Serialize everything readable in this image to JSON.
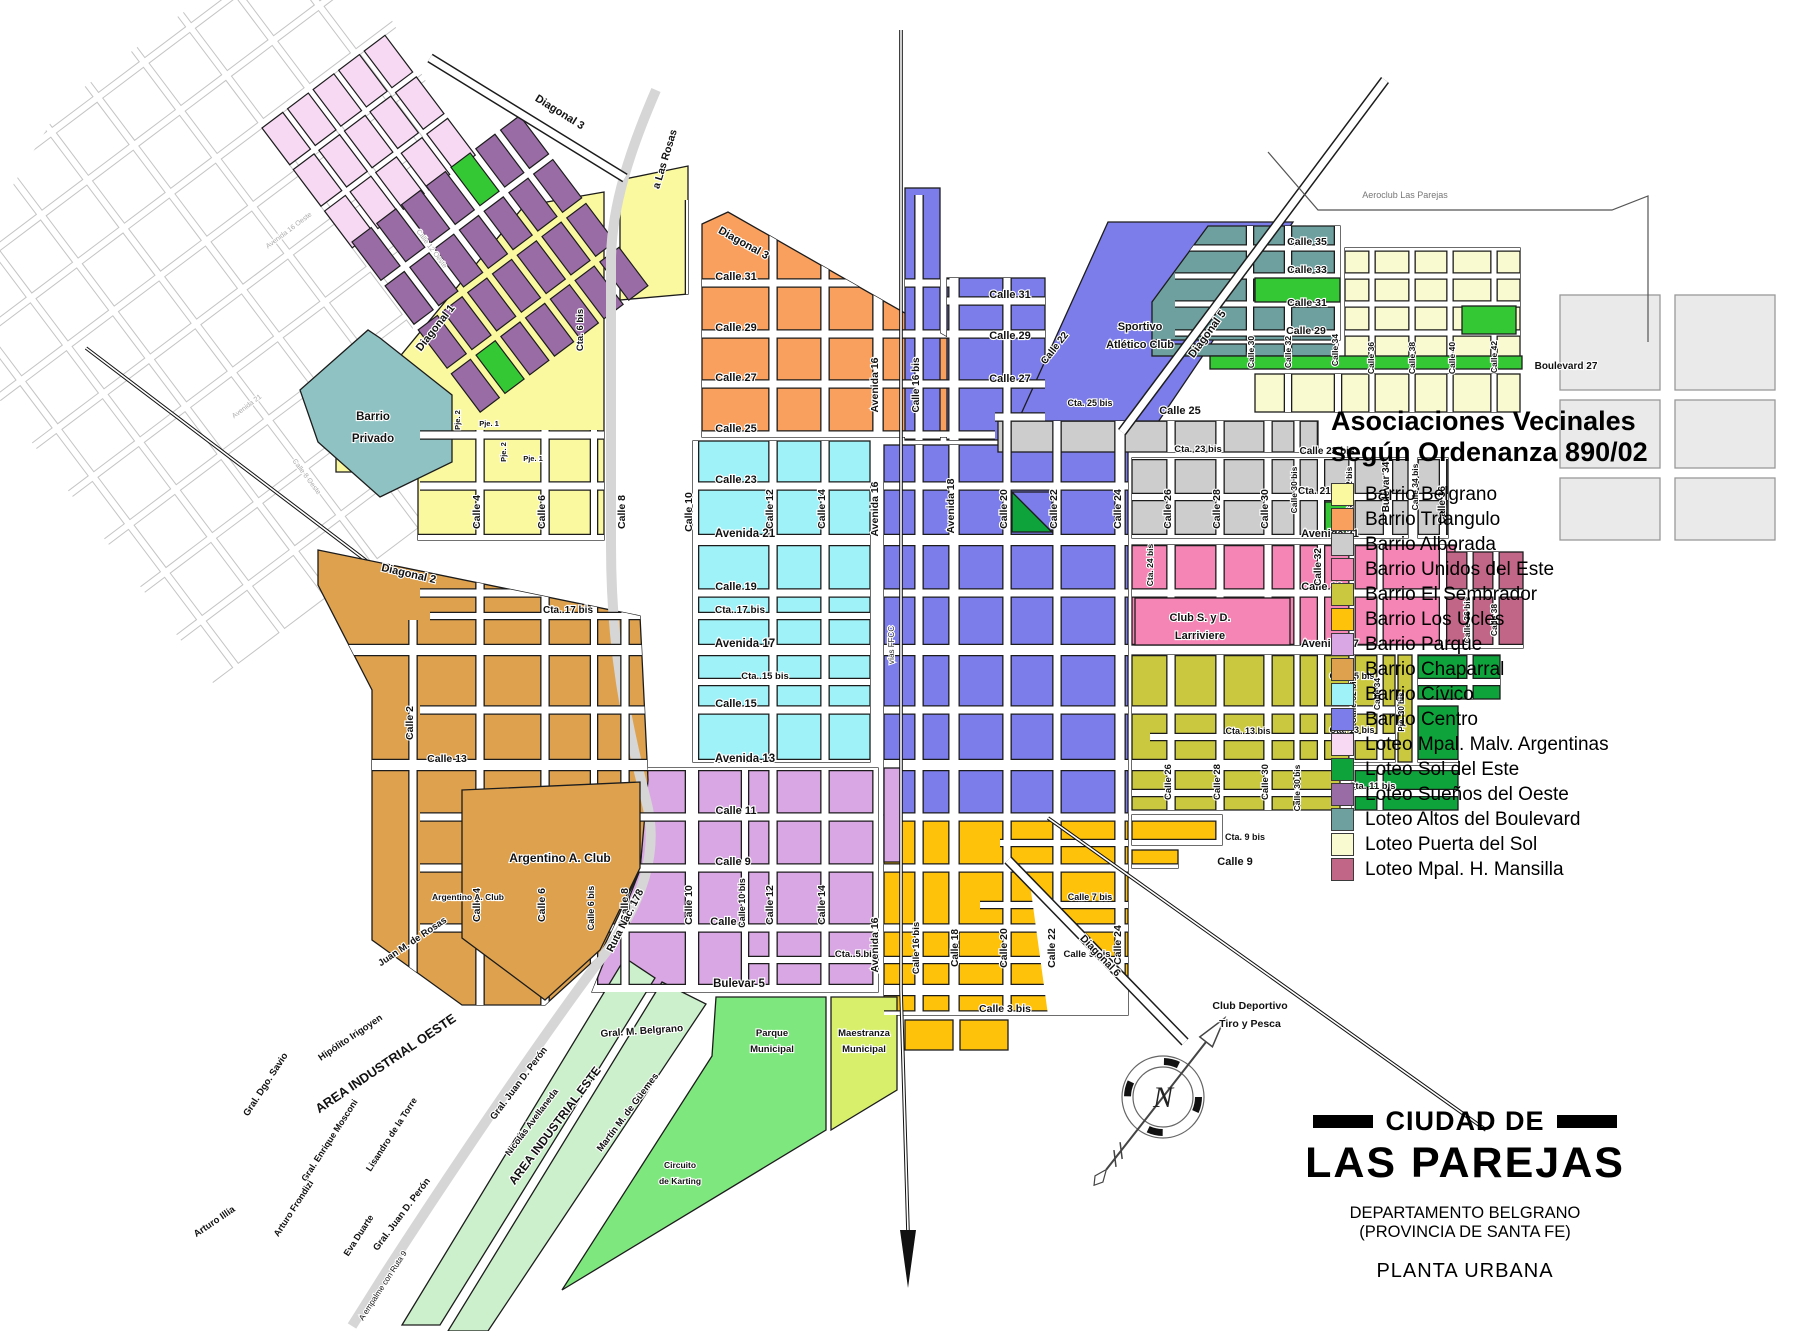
{
  "legend": {
    "title_line1": "Asociaciones Vecinales",
    "title_line2": "según Ordenanza 890/02",
    "items": [
      {
        "label": "Barrio Belgrano",
        "color": "#FAF9A0"
      },
      {
        "label": "Barrio Tríangulo",
        "color": "#F9A05F"
      },
      {
        "label": "Barrio Alborada",
        "color": "#CDCDCD"
      },
      {
        "label": "Barrio Unidos del Este",
        "color": "#F585B4"
      },
      {
        "label": "Barrio El Sembrador",
        "color": "#C9C83F"
      },
      {
        "label": "Barrio Los Ucles",
        "color": "#FFC20A"
      },
      {
        "label": "Barrio Parque",
        "color": "#D9A7E3"
      },
      {
        "label": "Barrio Chaparral",
        "color": "#DEA24F"
      },
      {
        "label": "Barrio Cívico",
        "color": "#9FF2F7"
      },
      {
        "label": "Barrio Centro",
        "color": "#7C7CEA"
      },
      {
        "label": "Loteo Mpal. Malv. Argentinas",
        "color": "#F7D9F3"
      },
      {
        "label": "Loteo Sol del Este",
        "color": "#0FA33C"
      },
      {
        "label": "Loteo Sueños del Oeste",
        "color": "#9A6CA5"
      },
      {
        "label": "Loteo Altos del Boulevard",
        "color": "#6FA0A0"
      },
      {
        "label": "Loteo Puerta del Sol",
        "color": "#FAFAD0"
      },
      {
        "label": "Loteo Mpal. H. Mansilla",
        "color": "#C26688"
      }
    ]
  },
  "title_block": {
    "pre": "CIUDAD DE",
    "city": "LAS PAREJAS",
    "dept": "DEPARTAMENTO BELGRANO",
    "prov": "(PROVINCIA DE SANTA FE)",
    "plan": "PLANTA URBANA"
  },
  "compass": {
    "letter": "N"
  },
  "colors": {
    "belgrano": "#FAF9A0",
    "triangulo": "#F9A05F",
    "alborada": "#CDCDCD",
    "unidos": "#F585B4",
    "sembrador": "#C9C83F",
    "ucles": "#FFC20A",
    "parque": "#D9A7E3",
    "chaparral": "#DEA24F",
    "civico": "#9FF2F7",
    "centro": "#7C7CEA",
    "malv": "#F7D9F3",
    "soleste": "#0FA33C",
    "suenos": "#9A6CA5",
    "altos": "#6FA0A0",
    "puertasol": "#FAFAD0",
    "mansilla": "#C26688",
    "bright_green": "#35C835",
    "industrial": "#CBF0CB",
    "parquem": "#7EE87E",
    "maestranza": "#D7EF6B",
    "privado": "#8FC3C3",
    "farright": "#EAEAEA",
    "road": "#D6D6D6",
    "rail": "#111111"
  },
  "labels": [
    {
      "t": "Calle 31",
      "x": 736,
      "y": 280
    },
    {
      "t": "Calle 29",
      "x": 736,
      "y": 331
    },
    {
      "t": "Calle 27",
      "x": 736,
      "y": 381
    },
    {
      "t": "Calle 25",
      "x": 736,
      "y": 432
    },
    {
      "t": "Calle 23",
      "x": 736,
      "y": 483
    },
    {
      "t": "Avenida 21",
      "x": 745,
      "y": 537,
      "s": 11.5
    },
    {
      "t": "Calle 19",
      "x": 736,
      "y": 590
    },
    {
      "t": "Cta. 17 bis",
      "x": 568,
      "y": 613,
      "s": 10
    },
    {
      "t": "Cta. 17 bis",
      "x": 740,
      "y": 613,
      "s": 10
    },
    {
      "t": "Avenida 17",
      "x": 745,
      "y": 647,
      "s": 11.5
    },
    {
      "t": "Cta. 15 bis",
      "x": 765,
      "y": 679,
      "s": 9.5
    },
    {
      "t": "Calle 15",
      "x": 736,
      "y": 707
    },
    {
      "t": "Avenida 13",
      "x": 745,
      "y": 762,
      "s": 11.5
    },
    {
      "t": "Calle 13",
      "x": 447,
      "y": 762,
      "s": 10.5
    },
    {
      "t": "Calle 11",
      "x": 736,
      "y": 814
    },
    {
      "t": "Calle 9",
      "x": 733,
      "y": 865
    },
    {
      "t": "Calle 7",
      "x": 728,
      "y": 925
    },
    {
      "t": "Cta. 5 bis",
      "x": 856,
      "y": 957,
      "s": 9.5
    },
    {
      "t": "Bulevar 5",
      "x": 739,
      "y": 987,
      "s": 11.5
    },
    {
      "t": "Calle 3 bis",
      "x": 1005,
      "y": 1012,
      "s": 10.5
    },
    {
      "t": "Calle 31",
      "x": 1010,
      "y": 298
    },
    {
      "t": "Calle 29",
      "x": 1010,
      "y": 339
    },
    {
      "t": "Calle 27",
      "x": 1010,
      "y": 382
    },
    {
      "t": "Cta. 25 bis",
      "x": 1090,
      "y": 406,
      "s": 9
    },
    {
      "t": "Calle 25",
      "x": 1180,
      "y": 414
    },
    {
      "t": "Cta. 23 bis",
      "x": 1198,
      "y": 452,
      "s": 9.5
    },
    {
      "t": "Calle 23 bis",
      "x": 1327,
      "y": 454,
      "s": 10
    },
    {
      "t": "Cta. 21 bis",
      "x": 1323,
      "y": 494,
      "s": 10
    },
    {
      "t": "Avenida 21",
      "x": 1330,
      "y": 537
    },
    {
      "t": "Calle 19",
      "x": 1322,
      "y": 590
    },
    {
      "t": "Avenida 17",
      "x": 1330,
      "y": 647
    },
    {
      "t": "Cta. 15 bis",
      "x": 1352,
      "y": 679,
      "s": 9
    },
    {
      "t": "Cta. 13 bis",
      "x": 1248,
      "y": 734,
      "s": 9
    },
    {
      "t": "Cta. 13 bis",
      "x": 1352,
      "y": 733,
      "s": 9
    },
    {
      "t": "Cta. 11 bis",
      "x": 1372,
      "y": 789,
      "s": 9.5
    },
    {
      "t": "Cta. 9 bis",
      "x": 1245,
      "y": 840,
      "s": 9
    },
    {
      "t": "Calle 9",
      "x": 1235,
      "y": 865
    },
    {
      "t": "Calle 7 bis",
      "x": 1090,
      "y": 900,
      "s": 9
    },
    {
      "t": "Calle 5 bis",
      "x": 1087,
      "y": 957,
      "s": 9.5
    },
    {
      "t": "Calle 35",
      "x": 1307,
      "y": 245,
      "s": 10.5
    },
    {
      "t": "Calle 33",
      "x": 1307,
      "y": 273,
      "s": 10.5
    },
    {
      "t": "Calle 31",
      "x": 1307,
      "y": 306,
      "s": 10.5
    },
    {
      "t": "Calle 29",
      "x": 1306,
      "y": 334,
      "s": 10.5
    },
    {
      "t": "Boulevard 27",
      "x": 1566,
      "y": 369,
      "s": 10
    },
    {
      "t": "Gral. M. Belgrano",
      "x": 642,
      "y": 1034,
      "s": 10,
      "r": -4
    },
    {
      "t": "Calle 4",
      "x": 480,
      "y": 512,
      "r": -90,
      "s": 10.5
    },
    {
      "t": "Calle 6",
      "x": 545,
      "y": 512,
      "r": -90,
      "s": 10.5
    },
    {
      "t": "Calle 8",
      "x": 625,
      "y": 512,
      "r": -90,
      "s": 10.5
    },
    {
      "t": "Calle 10",
      "x": 692,
      "y": 512,
      "r": -90,
      "s": 10.5
    },
    {
      "t": "Calle 12",
      "x": 773,
      "y": 509,
      "r": -90,
      "s": 10.5
    },
    {
      "t": "Calle 14",
      "x": 825,
      "y": 509,
      "r": -90,
      "s": 10.5
    },
    {
      "t": "Avenida 16",
      "x": 878,
      "y": 385,
      "r": -90,
      "s": 10.5
    },
    {
      "t": "Calle 16 bis",
      "x": 919,
      "y": 385,
      "r": -90,
      "s": 10
    },
    {
      "t": "Avenida 16",
      "x": 878,
      "y": 509,
      "r": -90,
      "s": 10.5
    },
    {
      "t": "Avenida 18",
      "x": 954,
      "y": 506,
      "r": -90,
      "s": 10.5
    },
    {
      "t": "Calle 20",
      "x": 1007,
      "y": 509,
      "r": -90,
      "s": 10.5
    },
    {
      "t": "Calle 22",
      "x": 1057,
      "y": 509,
      "r": -90,
      "s": 10.5
    },
    {
      "t": "Calle 22",
      "x": 1057,
      "y": 350,
      "r": -52,
      "s": 10
    },
    {
      "t": "Calle 24",
      "x": 1121,
      "y": 509,
      "r": -90,
      "s": 10.5
    },
    {
      "t": "Calle 26",
      "x": 1171,
      "y": 509,
      "r": -90,
      "s": 10.5
    },
    {
      "t": "Calle 28",
      "x": 1220,
      "y": 509,
      "r": -90,
      "s": 10.5
    },
    {
      "t": "Calle 30",
      "x": 1268,
      "y": 509,
      "r": -90,
      "s": 10.5
    },
    {
      "t": "Calle 30 bis",
      "x": 1297,
      "y": 490,
      "r": -90,
      "s": 8.5
    },
    {
      "t": "Cta. 24 bis",
      "x": 1153,
      "y": 565,
      "r": -90,
      "s": 8.5
    },
    {
      "t": "Calle 32",
      "x": 1321,
      "y": 567,
      "r": -90,
      "s": 10
    },
    {
      "t": "Calle 32 bis",
      "x": 1352,
      "y": 490,
      "r": -90,
      "s": 8.5
    },
    {
      "t": "Bulevar 34",
      "x": 1389,
      "y": 487,
      "r": -90,
      "s": 10
    },
    {
      "t": "Calle 34 bis",
      "x": 1418,
      "y": 487,
      "r": -90,
      "s": 8.5
    },
    {
      "t": "Calle 36",
      "x": 1445,
      "y": 505,
      "r": -90,
      "s": 10
    },
    {
      "t": "Calle 36 bis",
      "x": 1470,
      "y": 620,
      "r": -90,
      "s": 8.5
    },
    {
      "t": "Calle 38",
      "x": 1497,
      "y": 620,
      "r": -90,
      "s": 8.5
    },
    {
      "t": "Calle 32 bis",
      "x": 1356,
      "y": 700,
      "r": -90,
      "s": 8.5
    },
    {
      "t": "Calle 34",
      "x": 1380,
      "y": 694,
      "r": -90,
      "s": 8.5
    },
    {
      "t": "Pje. 30 bis",
      "x": 1404,
      "y": 712,
      "r": -90,
      "s": 8
    },
    {
      "t": "Calle 26",
      "x": 1171,
      "y": 782,
      "r": -90,
      "s": 9.5
    },
    {
      "t": "Calle 28",
      "x": 1220,
      "y": 782,
      "r": -90,
      "s": 9.5
    },
    {
      "t": "Calle 30",
      "x": 1268,
      "y": 782,
      "r": -90,
      "s": 9.5
    },
    {
      "t": "Calle 30 bis",
      "x": 1300,
      "y": 788,
      "r": -90,
      "s": 8.5
    },
    {
      "t": "Calle 2",
      "x": 413,
      "y": 723,
      "r": -90,
      "s": 10.5
    },
    {
      "t": "Calle 4",
      "x": 480,
      "y": 905,
      "r": -90,
      "s": 10.5
    },
    {
      "t": "Calle 6",
      "x": 545,
      "y": 905,
      "r": -90,
      "s": 10.5
    },
    {
      "t": "Calle 6 bis",
      "x": 594,
      "y": 908,
      "r": -90,
      "s": 9
    },
    {
      "t": "Calle 8",
      "x": 628,
      "y": 905,
      "r": -90,
      "s": 10.5
    },
    {
      "t": "Calle 10",
      "x": 692,
      "y": 905,
      "r": -90,
      "s": 10.5
    },
    {
      "t": "Calle 10 bis",
      "x": 745,
      "y": 903,
      "r": -90,
      "s": 9
    },
    {
      "t": "Calle 12",
      "x": 773,
      "y": 905,
      "r": -90,
      "s": 10.5
    },
    {
      "t": "Calle 14",
      "x": 825,
      "y": 905,
      "r": -90,
      "s": 10.5
    },
    {
      "t": "Avenida 16",
      "x": 878,
      "y": 945,
      "r": -90,
      "s": 10.5
    },
    {
      "t": "Calle 16 bis",
      "x": 919,
      "y": 948,
      "r": -90,
      "s": 9.5
    },
    {
      "t": "Calle 18",
      "x": 958,
      "y": 948,
      "r": -90,
      "s": 10
    },
    {
      "t": "Calle 20",
      "x": 1007,
      "y": 948,
      "r": -90,
      "s": 10.5
    },
    {
      "t": "Calle 22",
      "x": 1055,
      "y": 948,
      "r": -90,
      "s": 10.5
    },
    {
      "t": "Calle 24",
      "x": 1121,
      "y": 945,
      "r": -90,
      "s": 10.5
    },
    {
      "t": "vías FFCC",
      "x": 894,
      "y": 645,
      "r": -90,
      "s": 8,
      "w": "n",
      "c": "#333333"
    },
    {
      "t": "Pje. 2",
      "x": 460,
      "y": 420,
      "r": -90,
      "s": 7.5
    },
    {
      "t": "Pje. 1",
      "x": 489,
      "y": 426,
      "s": 7.5
    },
    {
      "t": "Pje. 2",
      "x": 506,
      "y": 452,
      "r": -90,
      "s": 7.5
    },
    {
      "t": "Pje. 1",
      "x": 533,
      "y": 461,
      "s": 7.5
    },
    {
      "t": "Cta. 6 bis",
      "x": 583,
      "y": 330,
      "r": -90,
      "s": 9.5
    },
    {
      "t": "Calle 30",
      "x": 1254,
      "y": 352,
      "r": -90,
      "s": 8.5
    },
    {
      "t": "Calle 32",
      "x": 1291,
      "y": 352,
      "r": -90,
      "s": 8.5
    },
    {
      "t": "Calle 34",
      "x": 1338,
      "y": 350,
      "r": -90,
      "s": 8.5
    },
    {
      "t": "Calle 36",
      "x": 1374,
      "y": 358,
      "r": -90,
      "s": 8.5
    },
    {
      "t": "Calle 38",
      "x": 1415,
      "y": 358,
      "r": -90,
      "s": 8.5
    },
    {
      "t": "Calle 40",
      "x": 1455,
      "y": 358,
      "r": -90,
      "s": 8.5
    },
    {
      "t": "Calle 42",
      "x": 1497,
      "y": 357,
      "r": -90,
      "s": 8.5
    },
    {
      "t": "Diagonal 3",
      "x": 558,
      "y": 115,
      "r": 32
    },
    {
      "t": "Diagonal 3",
      "x": 742,
      "y": 246,
      "r": 29
    },
    {
      "t": "a Las Rosas",
      "x": 668,
      "y": 160,
      "r": -73,
      "s": 10.5
    },
    {
      "t": "Diagonal 1",
      "x": 438,
      "y": 330,
      "r": -52
    },
    {
      "t": "Diagonal 2",
      "x": 408,
      "y": 577,
      "r": 13
    },
    {
      "t": "Diagonal 5",
      "x": 1210,
      "y": 336,
      "r": -54
    },
    {
      "t": "Diagonal 6",
      "x": 1098,
      "y": 958,
      "r": 46,
      "s": 10.5
    },
    {
      "t": "Ruta Nac. 178",
      "x": 628,
      "y": 922,
      "r": -63,
      "s": 10.5
    },
    {
      "t": "A empalme con Ruta 9",
      "x": 385,
      "y": 1287,
      "r": -57,
      "s": 8,
      "w": "n"
    },
    {
      "t": "Nicolás Avellaneda",
      "x": 534,
      "y": 1124,
      "r": -53,
      "s": 9
    },
    {
      "t": "Martín M. de Güemes",
      "x": 630,
      "y": 1114,
      "r": -53,
      "s": 9.5
    },
    {
      "t": "Gral. Juan D. Perón",
      "x": 521,
      "y": 1085,
      "r": -53,
      "s": 9.5
    },
    {
      "t": "Gral. Juan D. Perón",
      "x": 404,
      "y": 1216,
      "r": -53,
      "s": 9.5
    },
    {
      "t": "Juan M. de Rosas",
      "x": 414,
      "y": 944,
      "r": -34,
      "s": 9.5
    },
    {
      "t": "Hipólito Irigoyen",
      "x": 352,
      "y": 1040,
      "r": -34,
      "s": 9.5
    },
    {
      "t": "Gral. Dgo. Savio",
      "x": 268,
      "y": 1086,
      "r": -57,
      "s": 9.5
    },
    {
      "t": "Gral. Enrique Mosconi",
      "x": 332,
      "y": 1142,
      "r": -57,
      "s": 9
    },
    {
      "t": "Lisandro de la Torre",
      "x": 394,
      "y": 1136,
      "r": -57,
      "s": 9
    },
    {
      "t": "Arturo Frondizi",
      "x": 296,
      "y": 1210,
      "r": -57,
      "s": 9
    },
    {
      "t": "Eva Duarte",
      "x": 361,
      "y": 1237,
      "r": -57,
      "s": 9
    },
    {
      "t": "Arturo Illia",
      "x": 216,
      "y": 1224,
      "r": -34,
      "s": 9.5
    },
    {
      "t": "AREA INDUSTRIAL OESTE",
      "x": 388,
      "y": 1067,
      "r": -34,
      "s": 13
    },
    {
      "t": "AREA INDUSTRIAL ESTE",
      "x": 558,
      "y": 1128,
      "r": -53,
      "s": 12
    },
    {
      "t": "Barrio",
      "x": 373,
      "y": 420,
      "s": 11.5
    },
    {
      "t": "Privado",
      "x": 373,
      "y": 442,
      "s": 11.5
    },
    {
      "t": "Sportivo",
      "x": 1140,
      "y": 330,
      "s": 11
    },
    {
      "t": "Atlético Club",
      "x": 1140,
      "y": 348,
      "s": 11
    },
    {
      "t": "Club S. y D.",
      "x": 1200,
      "y": 621,
      "s": 11
    },
    {
      "t": "Larriviere",
      "x": 1200,
      "y": 639,
      "s": 11
    },
    {
      "t": "Argentino A. Club",
      "x": 560,
      "y": 862,
      "s": 12
    },
    {
      "t": "Argentino A. Club",
      "x": 468,
      "y": 900,
      "s": 8.5
    },
    {
      "t": "Parque",
      "x": 772,
      "y": 1036,
      "s": 9.5
    },
    {
      "t": "Municipal",
      "x": 772,
      "y": 1052,
      "s": 9.5
    },
    {
      "t": "Maestranza",
      "x": 864,
      "y": 1036,
      "s": 9.5
    },
    {
      "t": "Municipal",
      "x": 864,
      "y": 1052,
      "s": 9.5
    },
    {
      "t": "Circuito",
      "x": 680,
      "y": 1168,
      "s": 8.5
    },
    {
      "t": "de Karting",
      "x": 680,
      "y": 1184,
      "s": 8.5
    },
    {
      "t": "Club Deportivo",
      "x": 1250,
      "y": 1009,
      "s": 10.5
    },
    {
      "t": "Tiro y Pesca",
      "x": 1250,
      "y": 1027,
      "s": 10.5
    },
    {
      "t": "Aeroclub Las Parejas",
      "x": 1405,
      "y": 198,
      "s": 9,
      "w": "n",
      "c": "#777777"
    },
    {
      "t": "Avenida 16 Oeste",
      "x": 290,
      "y": 232,
      "r": -37,
      "s": 7,
      "w": "n",
      "c": "#aaaaaa"
    },
    {
      "t": "Calle 12 Oeste",
      "x": 430,
      "y": 250,
      "r": 53,
      "s": 7,
      "w": "n",
      "c": "#aaaaaa"
    },
    {
      "t": "Avenida 21",
      "x": 248,
      "y": 408,
      "r": -37,
      "s": 7,
      "w": "n",
      "c": "#aaaaaa"
    },
    {
      "t": "Calle 8 Oeste",
      "x": 305,
      "y": 478,
      "r": 53,
      "s": 7,
      "w": "n",
      "c": "#aaaaaa"
    }
  ]
}
